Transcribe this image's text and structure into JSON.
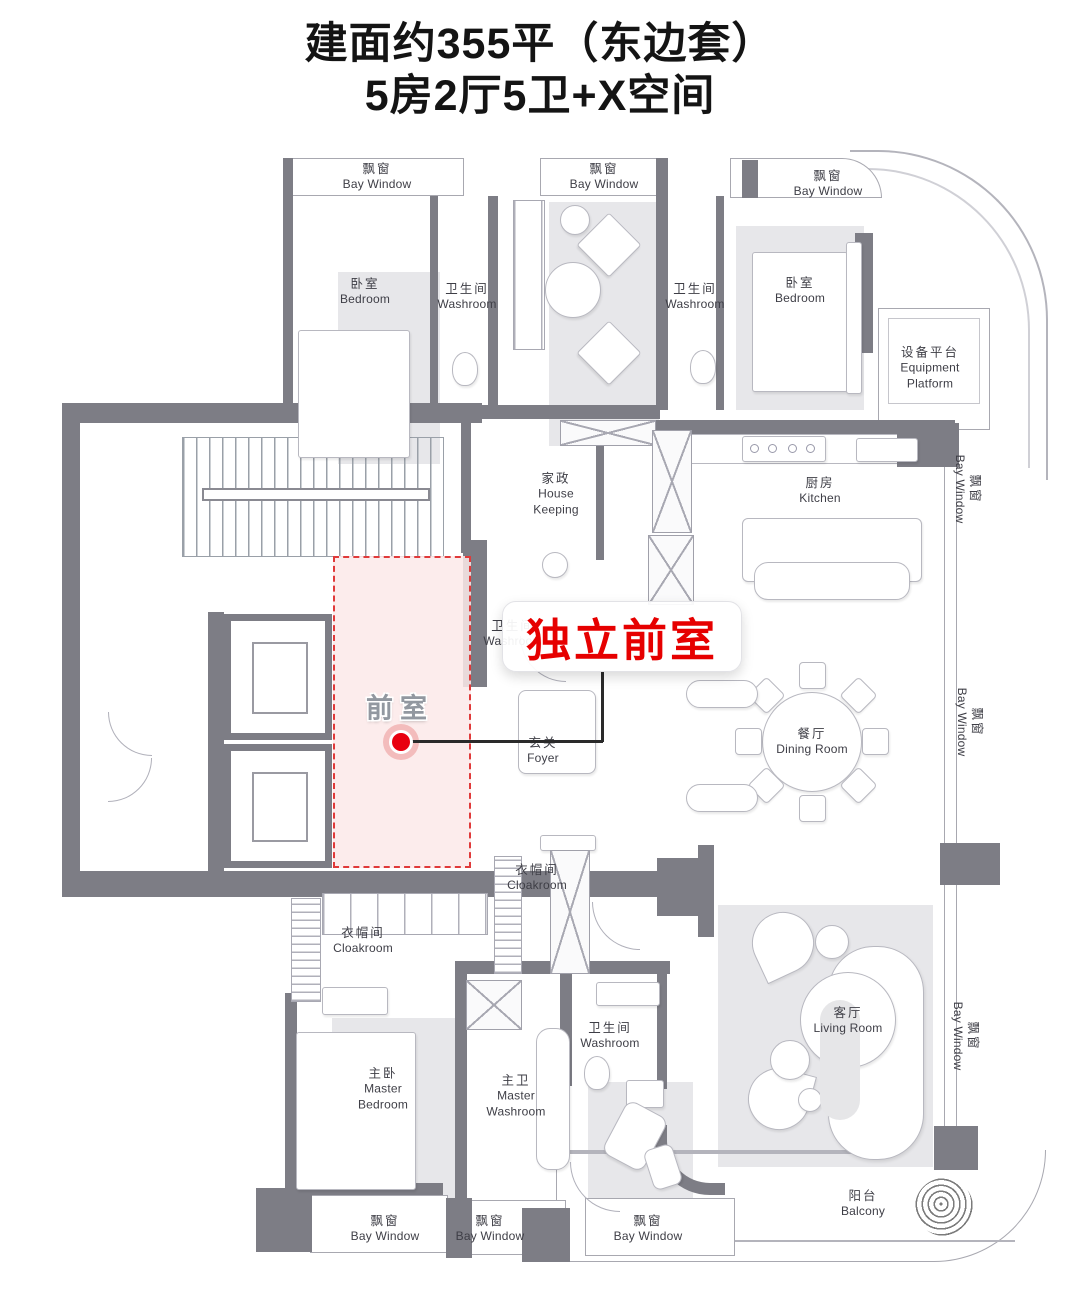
{
  "title": {
    "line1": "建面约355平（东边套）",
    "line2": "5房2厅5卫+X空间"
  },
  "callout": {
    "text": "独立前室"
  },
  "highlight": {
    "label": "前室"
  },
  "rooms": [
    {
      "id": "bay-window-top-left",
      "zh": "飘窗",
      "en": "Bay Window"
    },
    {
      "id": "bedroom-left",
      "zh": "卧室",
      "en": "Bedroom"
    },
    {
      "id": "washroom-top-1",
      "zh": "卫生间",
      "en": "Washroom"
    },
    {
      "id": "bay-window-top-mid",
      "zh": "飘窗",
      "en": "Bay Window"
    },
    {
      "id": "washroom-top-2",
      "zh": "卫生间",
      "en": "Washroom"
    },
    {
      "id": "bedroom-right",
      "zh": "卧室",
      "en": "Bedroom"
    },
    {
      "id": "bay-window-top-right",
      "zh": "飘窗",
      "en": "Bay Window"
    },
    {
      "id": "equipment-platform",
      "zh": "设备平台",
      "en": "Equipment Platform"
    },
    {
      "id": "house-keeping",
      "zh": "家政",
      "en": "House Keeping"
    },
    {
      "id": "kitchen",
      "zh": "厨房",
      "en": "Kitchen"
    },
    {
      "id": "bay-window-right-top",
      "zh": "飘窗",
      "en": "Bay Window"
    },
    {
      "id": "foyer",
      "zh": "玄关",
      "en": "Foyer"
    },
    {
      "id": "dining-room",
      "zh": "餐厅",
      "en": "Dining Room"
    },
    {
      "id": "bay-window-right-mid",
      "zh": "飘窗",
      "en": "Bay Window"
    },
    {
      "id": "washroom-foyer",
      "zh": "卫生间",
      "en": "Washroom"
    },
    {
      "id": "cloakroom-small",
      "zh": "衣帽间",
      "en": "Cloakroom"
    },
    {
      "id": "cloakroom-long",
      "zh": "衣帽间",
      "en": "Cloakroom"
    },
    {
      "id": "washroom-lower",
      "zh": "卫生间",
      "en": "Washroom"
    },
    {
      "id": "master-bedroom",
      "zh": "主卧",
      "en": "Master Bedroom"
    },
    {
      "id": "master-washroom",
      "zh": "主卫",
      "en": "Master Washroom"
    },
    {
      "id": "living-room",
      "zh": "客厅",
      "en": "Living Room"
    },
    {
      "id": "bay-window-right-bottom",
      "zh": "飘窗",
      "en": "Bay Window"
    },
    {
      "id": "balcony",
      "zh": "阳台",
      "en": "Balcony"
    },
    {
      "id": "bay-window-bottom-1",
      "zh": "飘窗",
      "en": "Bay Window"
    },
    {
      "id": "bay-window-bottom-2",
      "zh": "飘窗",
      "en": "Bay Window"
    },
    {
      "id": "bay-window-bottom-3",
      "zh": "飘窗",
      "en": "Bay Window"
    }
  ],
  "colors": {
    "wall": "#7d7d85",
    "highlight_fill": "#fbe9e9",
    "highlight_border": "#e03a3a",
    "callout_red": "#e60000"
  }
}
